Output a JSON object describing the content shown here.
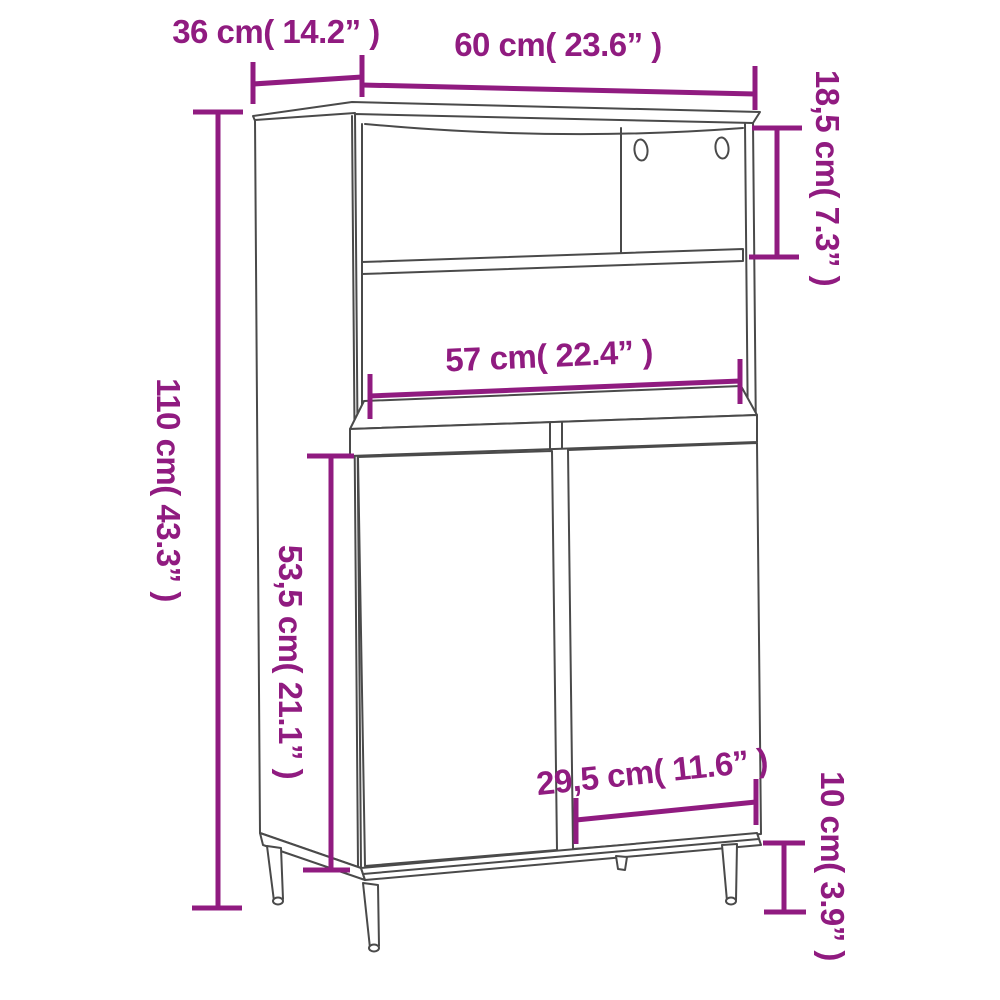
{
  "diagram": {
    "kind": "furniture-dimension-diagram",
    "subject": "highboard-cabinet-sketch",
    "accent_color": "#901b80",
    "sketch_line_color": "#4a4a4a",
    "background_color": "#ffffff",
    "units": {
      "primary": "cm",
      "secondary": "inches"
    },
    "dimensions": [
      {
        "id": "depth",
        "label": "36 cm( 14.2” )",
        "cm": "36",
        "inches": "14.2",
        "orientation": "horizontal"
      },
      {
        "id": "width",
        "label": "60 cm( 23.6” )",
        "cm": "60",
        "inches": "23.6",
        "orientation": "horizontal"
      },
      {
        "id": "top-compartment-height",
        "label": "18,5 cm( 7.3” )",
        "cm": "18,5",
        "inches": "7.3",
        "orientation": "vertical"
      },
      {
        "id": "total-height",
        "label": "110 cm( 43.3” )",
        "cm": "110",
        "inches": "43.3",
        "orientation": "vertical"
      },
      {
        "id": "inner-width",
        "label": "57 cm( 22.4” )",
        "cm": "57",
        "inches": "22.4",
        "orientation": "horizontal"
      },
      {
        "id": "door-height",
        "label": "53,5 cm( 21.1” )",
        "cm": "53,5",
        "inches": "21.1",
        "orientation": "vertical"
      },
      {
        "id": "door-width",
        "label": "29,5 cm( 11.6” )",
        "cm": "29,5",
        "inches": "11.6",
        "orientation": "horizontal"
      },
      {
        "id": "leg-height",
        "label": "10 cm( 3.9” )",
        "cm": "10",
        "inches": "3.9",
        "orientation": "vertical"
      }
    ]
  }
}
